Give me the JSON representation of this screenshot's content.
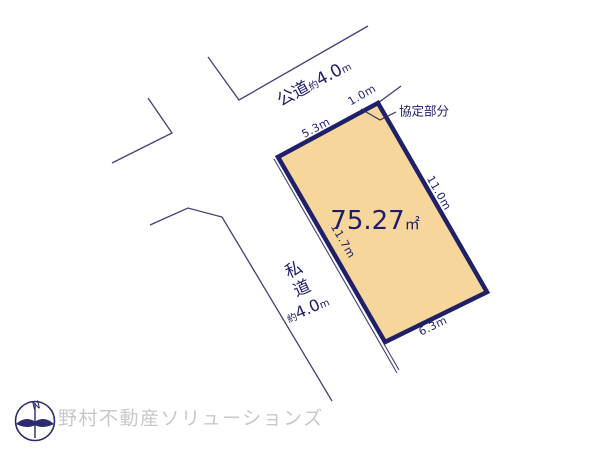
{
  "diagram": {
    "title_area": {
      "area_value": "75.27",
      "area_unit": "㎡"
    },
    "public_road": {
      "name": "公道",
      "approx": "約",
      "width": "4.0",
      "unit": "m"
    },
    "private_road": {
      "name": "私道",
      "approx": "約",
      "width": "4.0",
      "unit": "m"
    },
    "agreement_label": "協定部分",
    "dimensions": {
      "top": "5.3m",
      "top_corner": "1.0m",
      "right": "11.0m",
      "left": "11.7m",
      "bottom": "6.3m"
    },
    "colors": {
      "plot_fill": "#f6d69b",
      "plot_border": "#20206a",
      "line": "#404079",
      "text": "#1d1d6b",
      "watermark": "#c8c8c8"
    }
  },
  "footer": {
    "compass_north": "N",
    "company": "野村不動産ソリューションズ"
  }
}
